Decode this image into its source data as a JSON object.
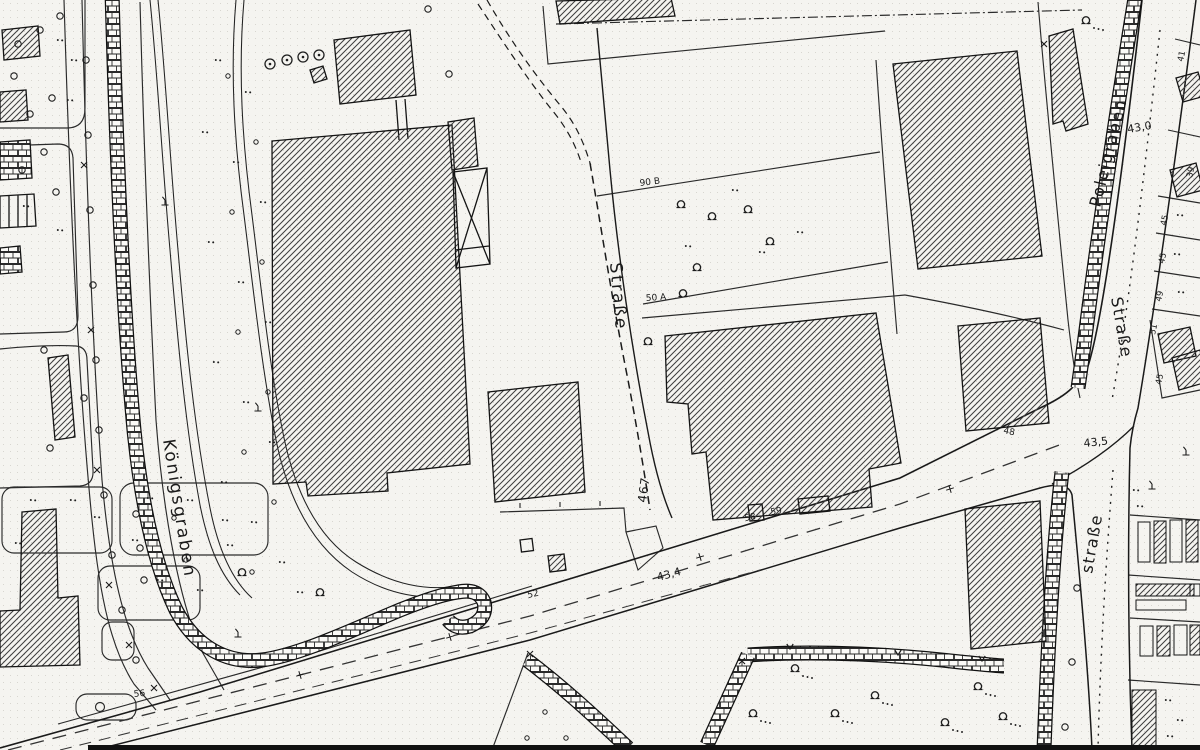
{
  "map": {
    "region_labels": {
      "koenigsgraben": "Königsgraben",
      "poleigraben": "Poleigraben"
    },
    "street_labels": {
      "center": "Straße",
      "right_upper": "Straße",
      "right_lower": "straße",
      "center_number": "467"
    },
    "elevation_marks": {
      "junction_north": "43,0",
      "junction_south": "43,5",
      "road_center": "43,4"
    },
    "parcel_numbers": {
      "p90b": "90 B",
      "p50a": "50 A",
      "p52": "52",
      "p56": "56",
      "p58": "58",
      "p59": "59",
      "p48": "48"
    },
    "house_numbers": {
      "n41": "41",
      "n39": "39",
      "n45a": "45",
      "n45b": "45",
      "n49": "49",
      "n51": "51",
      "n45c": "45"
    },
    "ink_color": "#1a1a1a",
    "paper_color": "#f5f4f0"
  }
}
